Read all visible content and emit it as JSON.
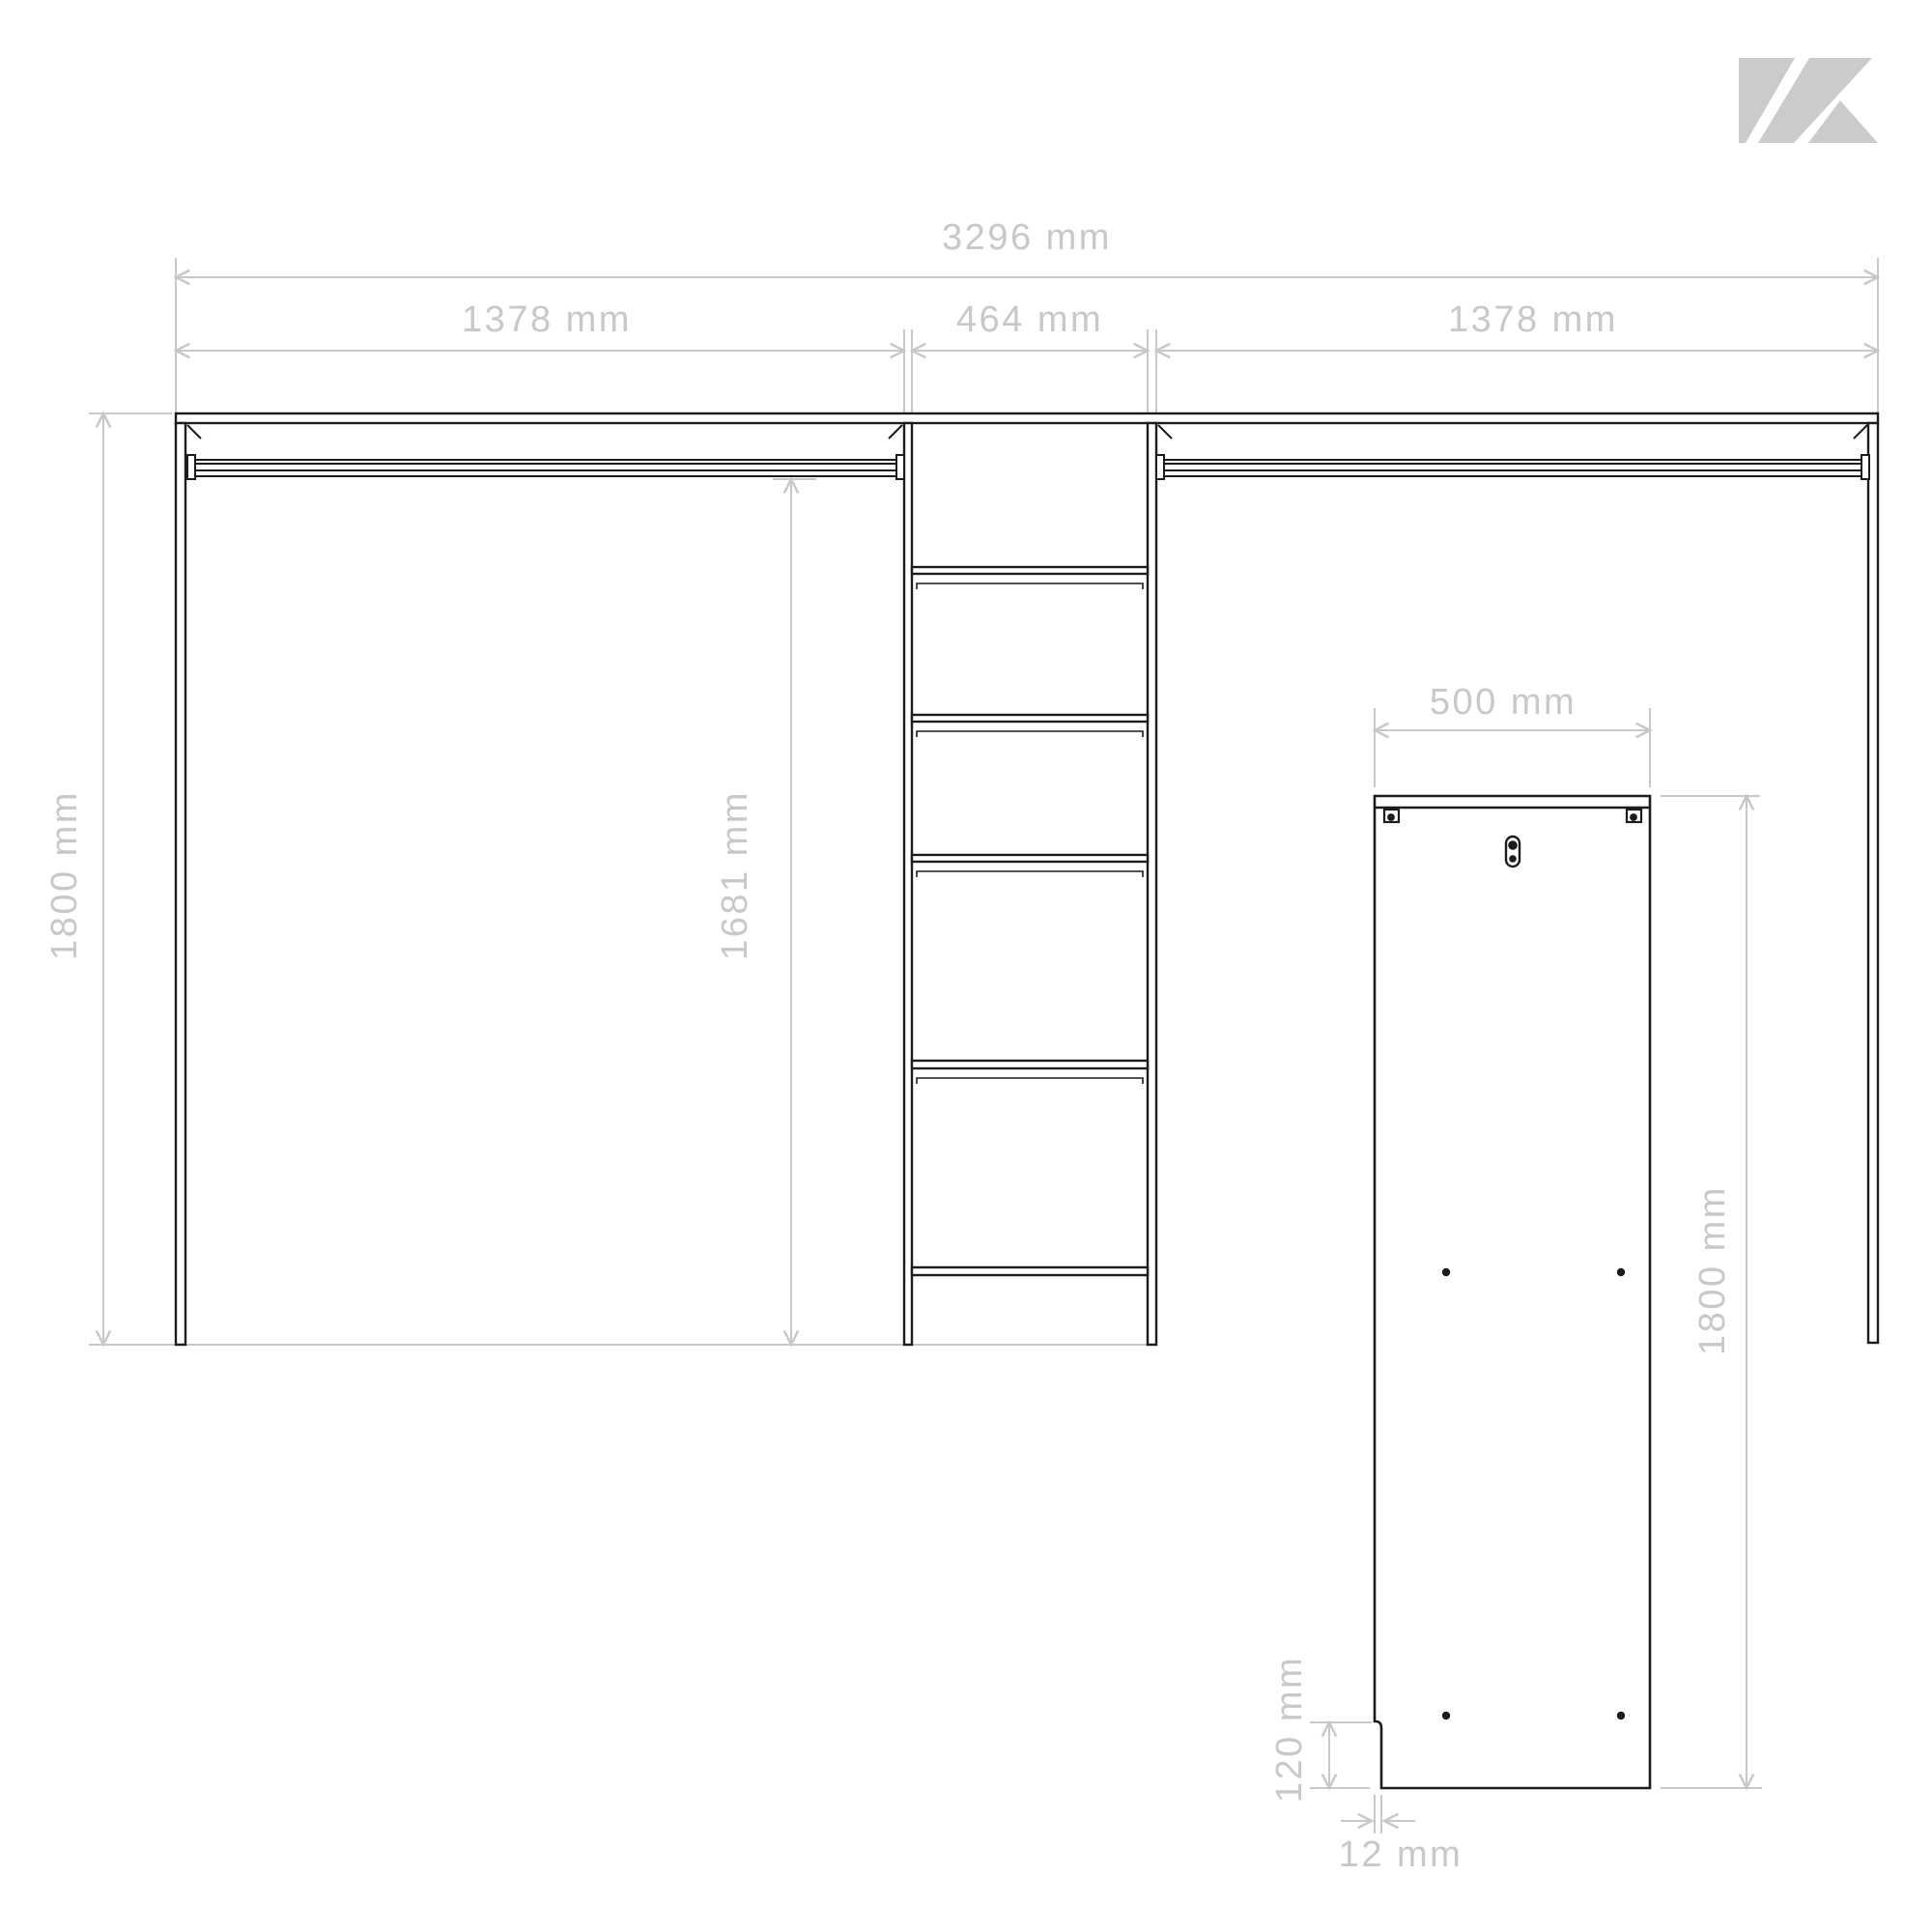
{
  "page": {
    "background_color": "#ffffff",
    "line_color": "#1c1c1c",
    "dimension_color": "#c6c9c9",
    "logo_color": "#c9cbcc"
  },
  "wardrobe_drawing": {
    "description": "open wardrobe front view with center shelf tower and two hanging rails",
    "dim_total_width": "3296 mm",
    "dim_left_section_width": "1378 mm",
    "dim_center_section_width": "464 mm",
    "dim_right_section_width": "1378 mm",
    "dim_total_height": "1800 mm",
    "dim_interior_height": "1681 mm"
  },
  "side_panel_drawing": {
    "description": "single side panel with wall brackets, keyhole slot, dowel holes and bottom notch",
    "dim_width": "500 mm",
    "dim_height": "1800 mm",
    "dim_notch_height": "120 mm",
    "dim_notch_width": "12 mm"
  }
}
